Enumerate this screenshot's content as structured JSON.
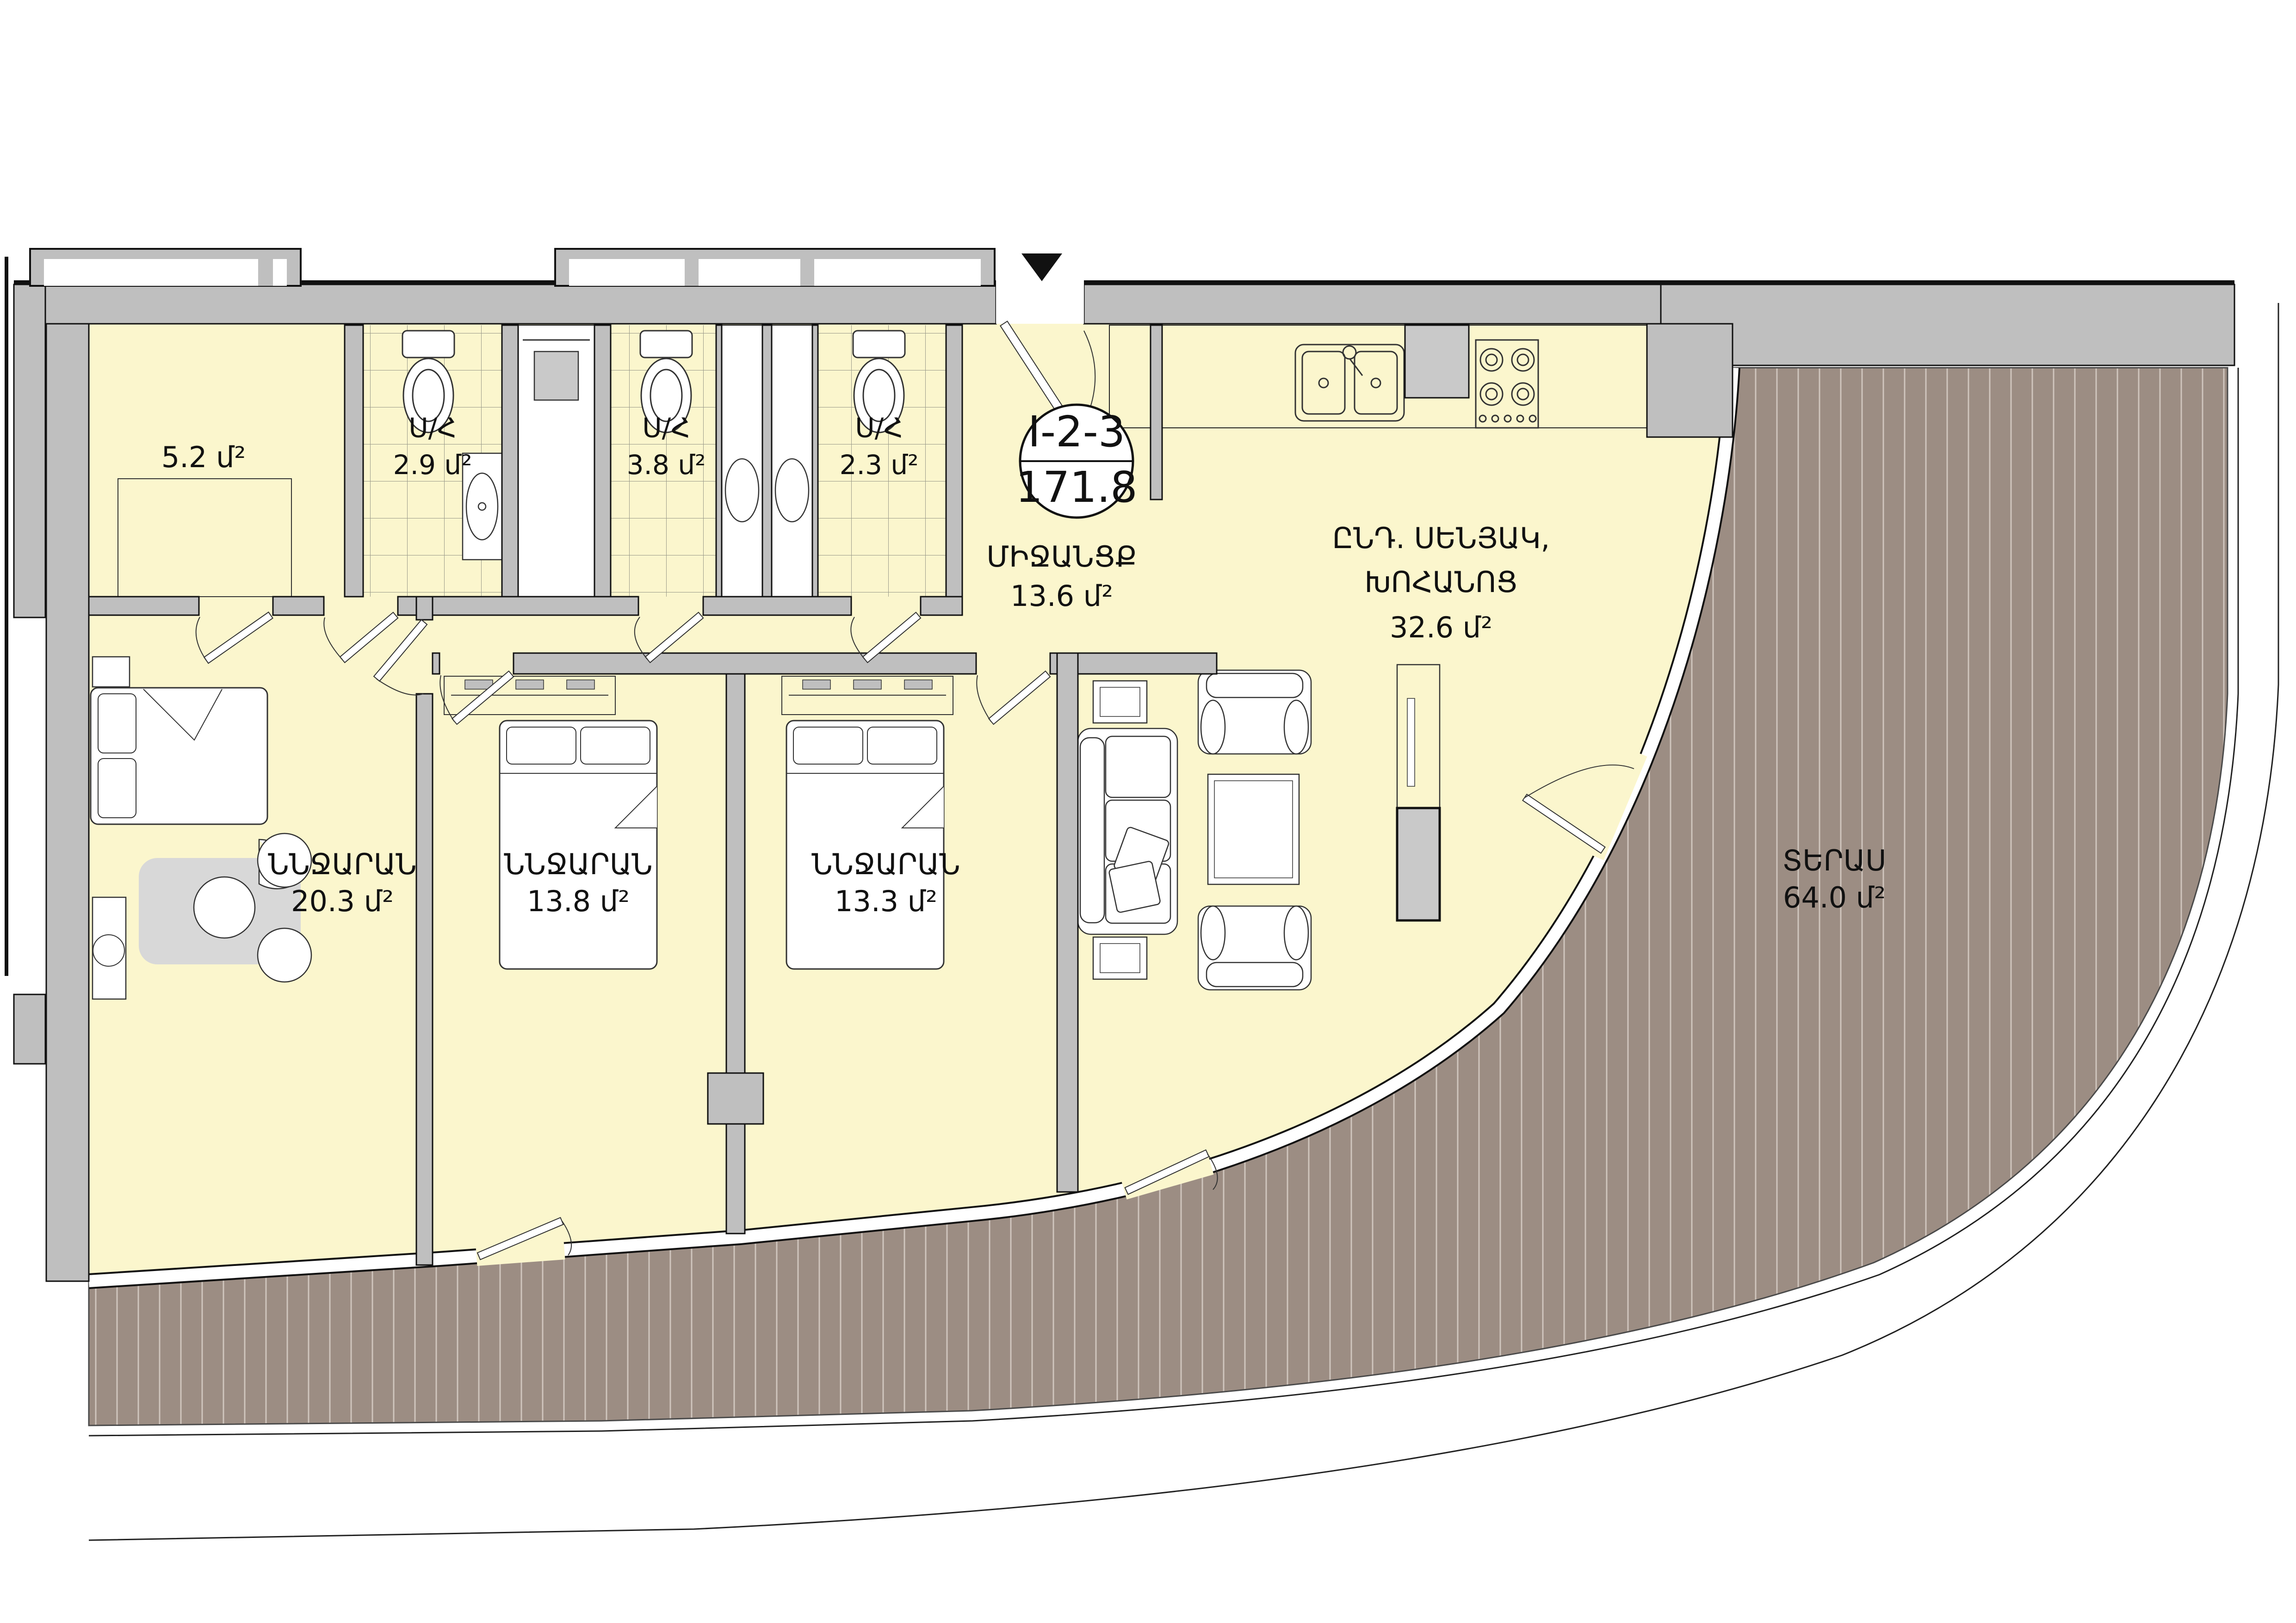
{
  "badge": {
    "code": "I-2-3",
    "area": "171.8"
  },
  "rooms": {
    "storage": {
      "area": "5.2 մ²"
    },
    "bath1": {
      "name": "Ս/Հ",
      "area": "2.9 մ²"
    },
    "bath2": {
      "name": "Ս/Հ",
      "area": "3.8 մ²"
    },
    "bath3": {
      "name": "Ս/Հ",
      "area": "2.3 մ²"
    },
    "corridor": {
      "name": "ՄԻՋԱՆՑՔ",
      "area": "13.6 մ²"
    },
    "living": {
      "name_line1": "ԸՆԴ. ՍԵՆՅԱԿ,",
      "name_line2": "ԽՈՀԱՆՈՑ",
      "area": "32.6 մ²"
    },
    "bedroom1": {
      "name": "ՆՆՋԱՐԱՆ",
      "area": "20.3 մ²"
    },
    "bedroom2": {
      "name": "ՆՆՋԱՐԱՆ",
      "area": "13.8 մ²"
    },
    "bedroom3": {
      "name": "ՆՆՋԱՐԱՆ",
      "area": "13.3 մ²"
    },
    "terrace": {
      "name": "ՏԵՐԱՍ",
      "area": "64.0 մ²"
    }
  },
  "colors": {
    "floor": "#FBF6CD",
    "wall": "#BFBFBF",
    "terrace": "#9C8D83",
    "terrace_stripe": "#CFC5BD",
    "furniture_gray": "#D8D8D8",
    "outline": "#111111"
  }
}
